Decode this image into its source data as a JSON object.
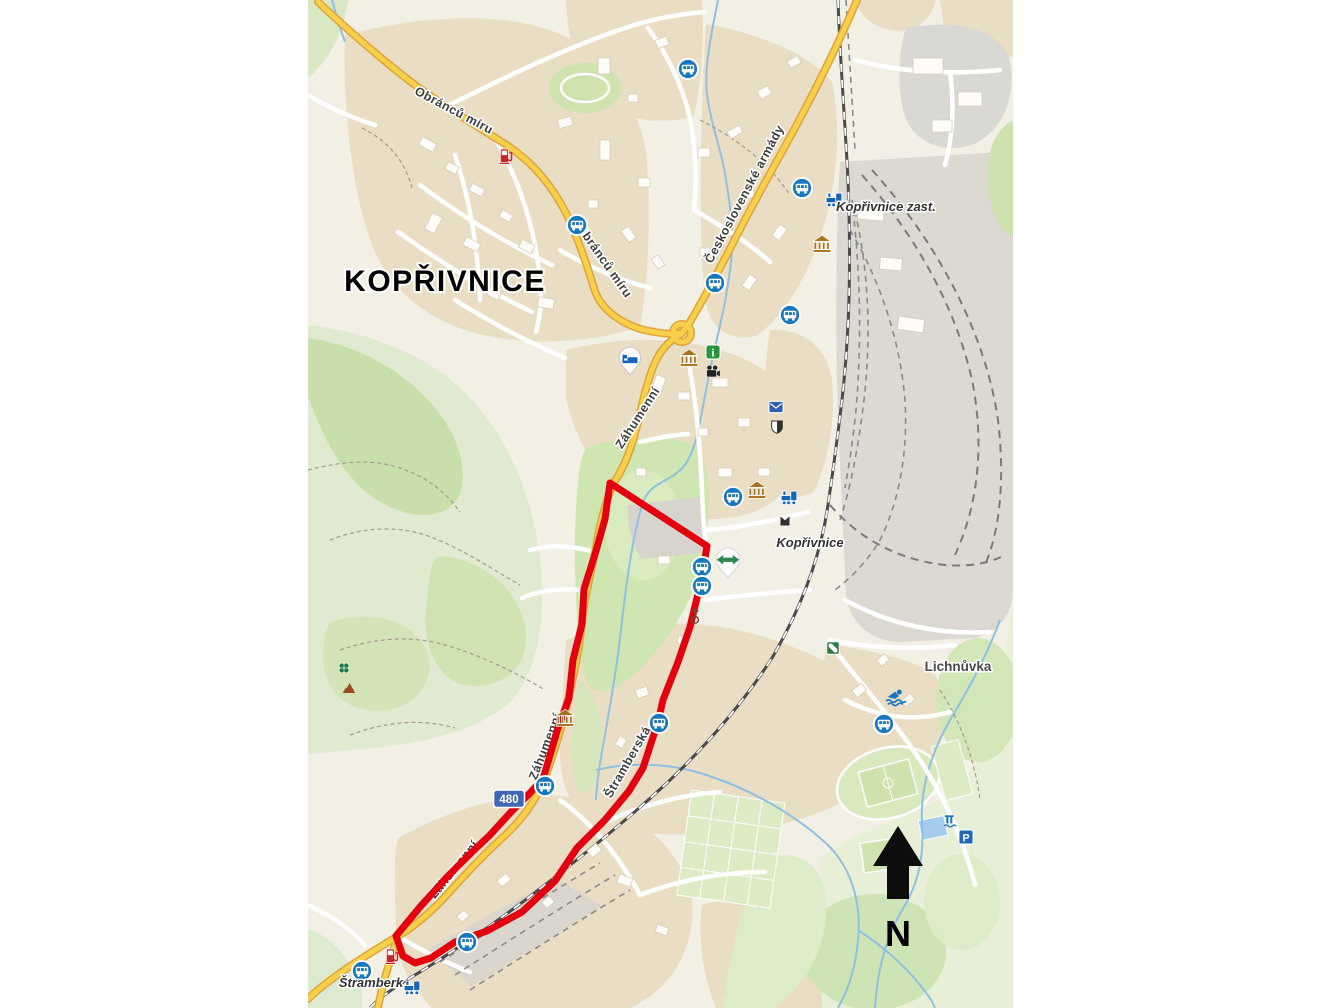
{
  "map": {
    "title": "KOPŘIVNICE",
    "colors": {
      "route": "#e3000f",
      "road_primary": "#f7d04b",
      "road_casing": "#dfa43c",
      "water": "#8fc0e2",
      "residential": "#e9ddc4",
      "industrial": "#dbd9d2",
      "forest": "#c9dfab",
      "park": "#cfe5b2",
      "background": "#f2efe4",
      "bus_icon": "#1878be"
    },
    "route": {
      "color": "#e3000f",
      "points": [
        [
          610,
          483
        ],
        [
          707,
          546
        ],
        [
          702,
          577
        ],
        [
          690,
          627
        ],
        [
          678,
          662
        ],
        [
          663,
          700
        ],
        [
          658,
          722
        ],
        [
          643,
          768
        ],
        [
          629,
          791
        ],
        [
          605,
          820
        ],
        [
          577,
          848
        ],
        [
          555,
          881
        ],
        [
          522,
          912
        ],
        [
          487,
          931
        ],
        [
          455,
          942
        ],
        [
          431,
          958
        ],
        [
          415,
          963
        ],
        [
          403,
          956
        ],
        [
          396,
          936
        ],
        [
          420,
          907
        ],
        [
          447,
          877
        ],
        [
          472,
          852
        ],
        [
          490,
          835
        ],
        [
          511,
          812
        ],
        [
          529,
          794
        ],
        [
          543,
          779
        ],
        [
          558,
          728
        ],
        [
          569,
          698
        ],
        [
          573,
          660
        ],
        [
          582,
          624
        ],
        [
          584,
          589
        ],
        [
          596,
          551
        ],
        [
          605,
          519
        ]
      ]
    },
    "route_shield": {
      "text": "480",
      "x": 509,
      "y": 799,
      "fill": "#3e68b5"
    },
    "north": {
      "label": "N"
    },
    "labels": [
      {
        "text": "KOPŘIVNICE",
        "x": 445,
        "y": 291,
        "rot": 0,
        "cls": "city"
      },
      {
        "text": "Obránců míru",
        "x": 452,
        "y": 114,
        "rot": 28,
        "cls": "street"
      },
      {
        "text": "Obránců míru",
        "x": 601,
        "y": 263,
        "rot": 55,
        "cls": "street"
      },
      {
        "text": "Československé armády",
        "x": 748,
        "y": 196,
        "rot": -62,
        "cls": "street"
      },
      {
        "text": "Záhumenní",
        "x": 641,
        "y": 420,
        "rot": -57,
        "cls": "street"
      },
      {
        "text": "Záhumenní",
        "x": 549,
        "y": 748,
        "rot": -69,
        "cls": "street"
      },
      {
        "text": "Záhumenní",
        "x": 457,
        "y": 872,
        "rot": -51,
        "cls": "street"
      },
      {
        "text": "Štramberská",
        "x": 631,
        "y": 764,
        "rot": -60,
        "cls": "street"
      },
      {
        "text": "Kopřivnice zast.",
        "x": 886,
        "y": 211,
        "rot": 0,
        "cls": "station"
      },
      {
        "text": "Kopřivnice",
        "x": 810,
        "y": 547,
        "rot": 0,
        "cls": "station"
      },
      {
        "text": "Lichnůvka",
        "x": 958,
        "y": 671,
        "rot": 0,
        "cls": "place"
      },
      {
        "text": "Štramberk",
        "x": 371,
        "y": 987,
        "rot": 0,
        "cls": "station"
      },
      {
        "text": "N",
        "x": 898,
        "y": 946,
        "rot": 0,
        "cls": "north"
      }
    ],
    "icons": [
      {
        "type": "fuel-station",
        "x": 506,
        "y": 156
      },
      {
        "type": "bus-stop",
        "x": 577,
        "y": 225
      },
      {
        "type": "bus-stop",
        "x": 688,
        "y": 69
      },
      {
        "type": "bus-stop",
        "x": 802,
        "y": 188
      },
      {
        "type": "train-station",
        "x": 834,
        "y": 200
      },
      {
        "type": "museum",
        "x": 822,
        "y": 244
      },
      {
        "type": "bus-stop",
        "x": 715,
        "y": 283
      },
      {
        "type": "bus-stop",
        "x": 790,
        "y": 315
      },
      {
        "type": "info-centre",
        "x": 713,
        "y": 352
      },
      {
        "type": "museum",
        "x": 689,
        "y": 358
      },
      {
        "type": "hotel",
        "x": 630,
        "y": 361
      },
      {
        "type": "cinema",
        "x": 713,
        "y": 372
      },
      {
        "type": "post-office",
        "x": 776,
        "y": 407
      },
      {
        "type": "memorial",
        "x": 777,
        "y": 427
      },
      {
        "type": "museum",
        "x": 757,
        "y": 490
      },
      {
        "type": "bus-stop",
        "x": 733,
        "y": 497
      },
      {
        "type": "train-station",
        "x": 789,
        "y": 498
      },
      {
        "type": "station-building",
        "x": 785,
        "y": 521
      },
      {
        "type": "fitness",
        "x": 728,
        "y": 563
      },
      {
        "type": "bus-stop",
        "x": 702,
        "y": 567
      },
      {
        "type": "bus-stop",
        "x": 702,
        "y": 586
      },
      {
        "type": "church",
        "x": 695,
        "y": 616
      },
      {
        "type": "sports-ground",
        "x": 833,
        "y": 648
      },
      {
        "type": "clover",
        "x": 344,
        "y": 668
      },
      {
        "type": "peak",
        "x": 349,
        "y": 688
      },
      {
        "type": "swimming-pool",
        "x": 896,
        "y": 697
      },
      {
        "type": "museum",
        "x": 565,
        "y": 718
      },
      {
        "type": "bus-stop",
        "x": 659,
        "y": 723
      },
      {
        "type": "bus-stop",
        "x": 884,
        "y": 724
      },
      {
        "type": "bus-stop",
        "x": 545,
        "y": 786
      },
      {
        "type": "weir",
        "x": 951,
        "y": 822
      },
      {
        "type": "parking",
        "x": 966,
        "y": 837
      },
      {
        "type": "bus-stop",
        "x": 467,
        "y": 942
      },
      {
        "type": "fuel-station",
        "x": 392,
        "y": 956
      },
      {
        "type": "bus-stop",
        "x": 362,
        "y": 971
      },
      {
        "type": "train-station",
        "x": 412,
        "y": 988
      }
    ]
  }
}
